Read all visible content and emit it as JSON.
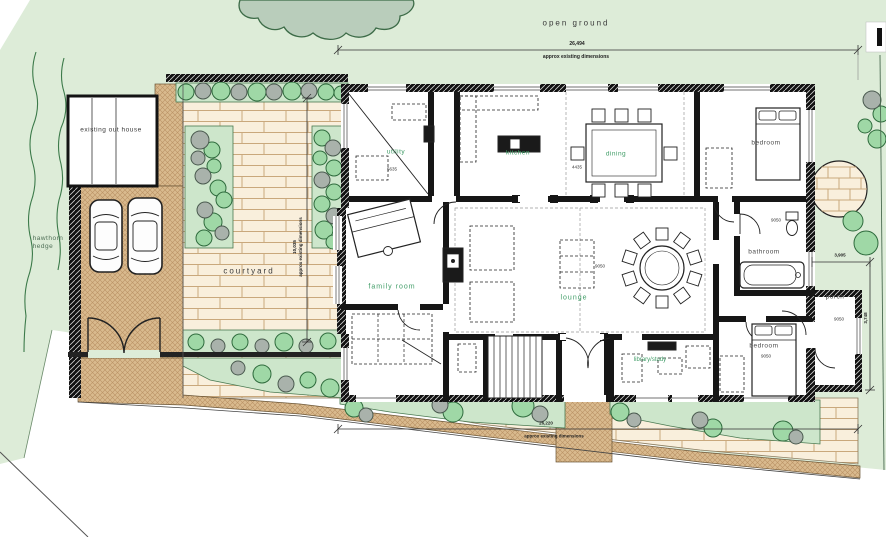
{
  "document": {
    "type": "architectural site / ground floor plan"
  },
  "labels": {
    "open_ground": "open ground",
    "existing_out_house": "existing out house",
    "hawthorn_line1": "hawthorn",
    "hawthorn_line2": "hedge",
    "courtyard": "courtyard",
    "utility": "utility",
    "kitchen": "kitchen",
    "dining": "dining",
    "bedroom_top": "bedroom",
    "bathroom": "bathroom",
    "porch": "porch",
    "bedroom_bottom": "bedroom",
    "family_room": "family room",
    "lounge": "lounge",
    "library_study": "library/study"
  },
  "room_numbers": {
    "utility": "5635",
    "kitchen_dining": "4435",
    "lounge": "9050",
    "bathroom": "9050",
    "porch": "9050",
    "bedroom_bottom": "9050"
  },
  "dimensions": {
    "top": {
      "value": "26,494",
      "caption": "approx existing dimensions"
    },
    "bottom": {
      "value": "26,220",
      "caption": "approx existing dimensions"
    },
    "courtyard": {
      "value": "10,035",
      "caption": "approx existing dimensions"
    },
    "porch_width": {
      "value": "3,905"
    },
    "porch_depth": {
      "value": "3,748"
    }
  },
  "colors": {
    "open_ground_green": "#ddecd8",
    "canopy_green": "#b9cdbb",
    "paving_tan": "#d9ba8e",
    "limestone_cream": "#f9efdc",
    "bush_green": "#9fd8a6",
    "bush_grey": "#a9b2ab",
    "label_green": "#3f9c66",
    "wall_black": "#131313"
  }
}
